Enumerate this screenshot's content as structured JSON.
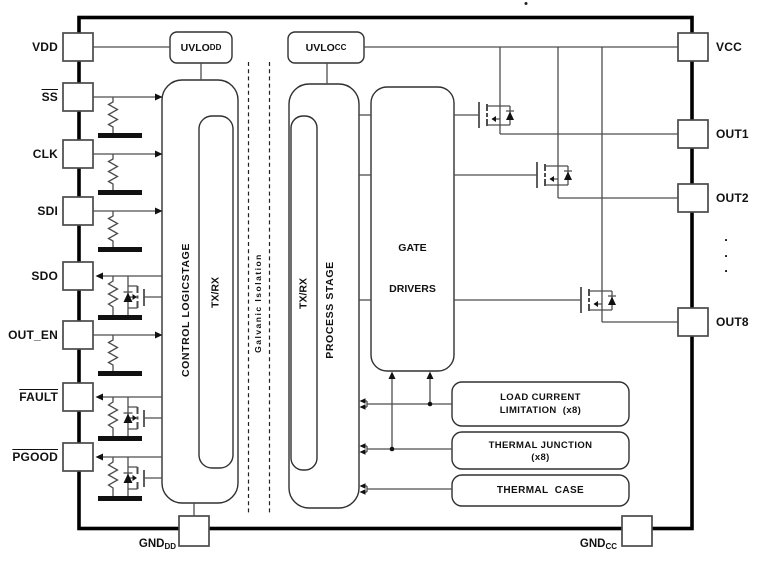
{
  "chip": {
    "stray_dot": ".",
    "left_pins": [
      {
        "label": "VDD"
      },
      {
        "label": "SS"
      },
      {
        "label": "CLK"
      },
      {
        "label": "SDI"
      },
      {
        "label": "SDO"
      },
      {
        "label": "OUT_EN"
      },
      {
        "label": "FAULT"
      },
      {
        "label": "PGOOD"
      }
    ],
    "right_pins": [
      {
        "label": "VCC"
      },
      {
        "label": "OUT1"
      },
      {
        "label": "OUT2"
      },
      {
        "label": "OUT8"
      }
    ],
    "right_ellipsis": ".\n.\n.",
    "bottom_pins": [
      {
        "base": "GND",
        "sub": "DD"
      },
      {
        "base": "GND",
        "sub": "CC"
      }
    ],
    "blocks": {
      "uvlo_dd": {
        "base": "UVLO",
        "sub": "DD"
      },
      "uvlo_cc": {
        "base": "UVLO",
        "sub": "CC"
      },
      "control_logic_stage": "CONTROL LOGICSTAGE",
      "txrx_left": "TX/RX",
      "txrx_right": "TX/RX",
      "galvanic_isolation": "Galvanic Isolation",
      "process_stage": "PROCESS STAGE",
      "gate_drivers": {
        "line1": "GATE",
        "line2": "DRIVERS"
      },
      "load_current": {
        "line1": "LOAD CURRENT",
        "line2": "LIMITATION  (x8)"
      },
      "thermal_junction": {
        "line1": "THERMAL JUNCTION",
        "line2": "(x8)"
      },
      "thermal_case": "THERMAL  CASE"
    },
    "colors": {
      "wire": "#4d4d4d",
      "ink": "#111111",
      "border": "#000000"
    }
  }
}
